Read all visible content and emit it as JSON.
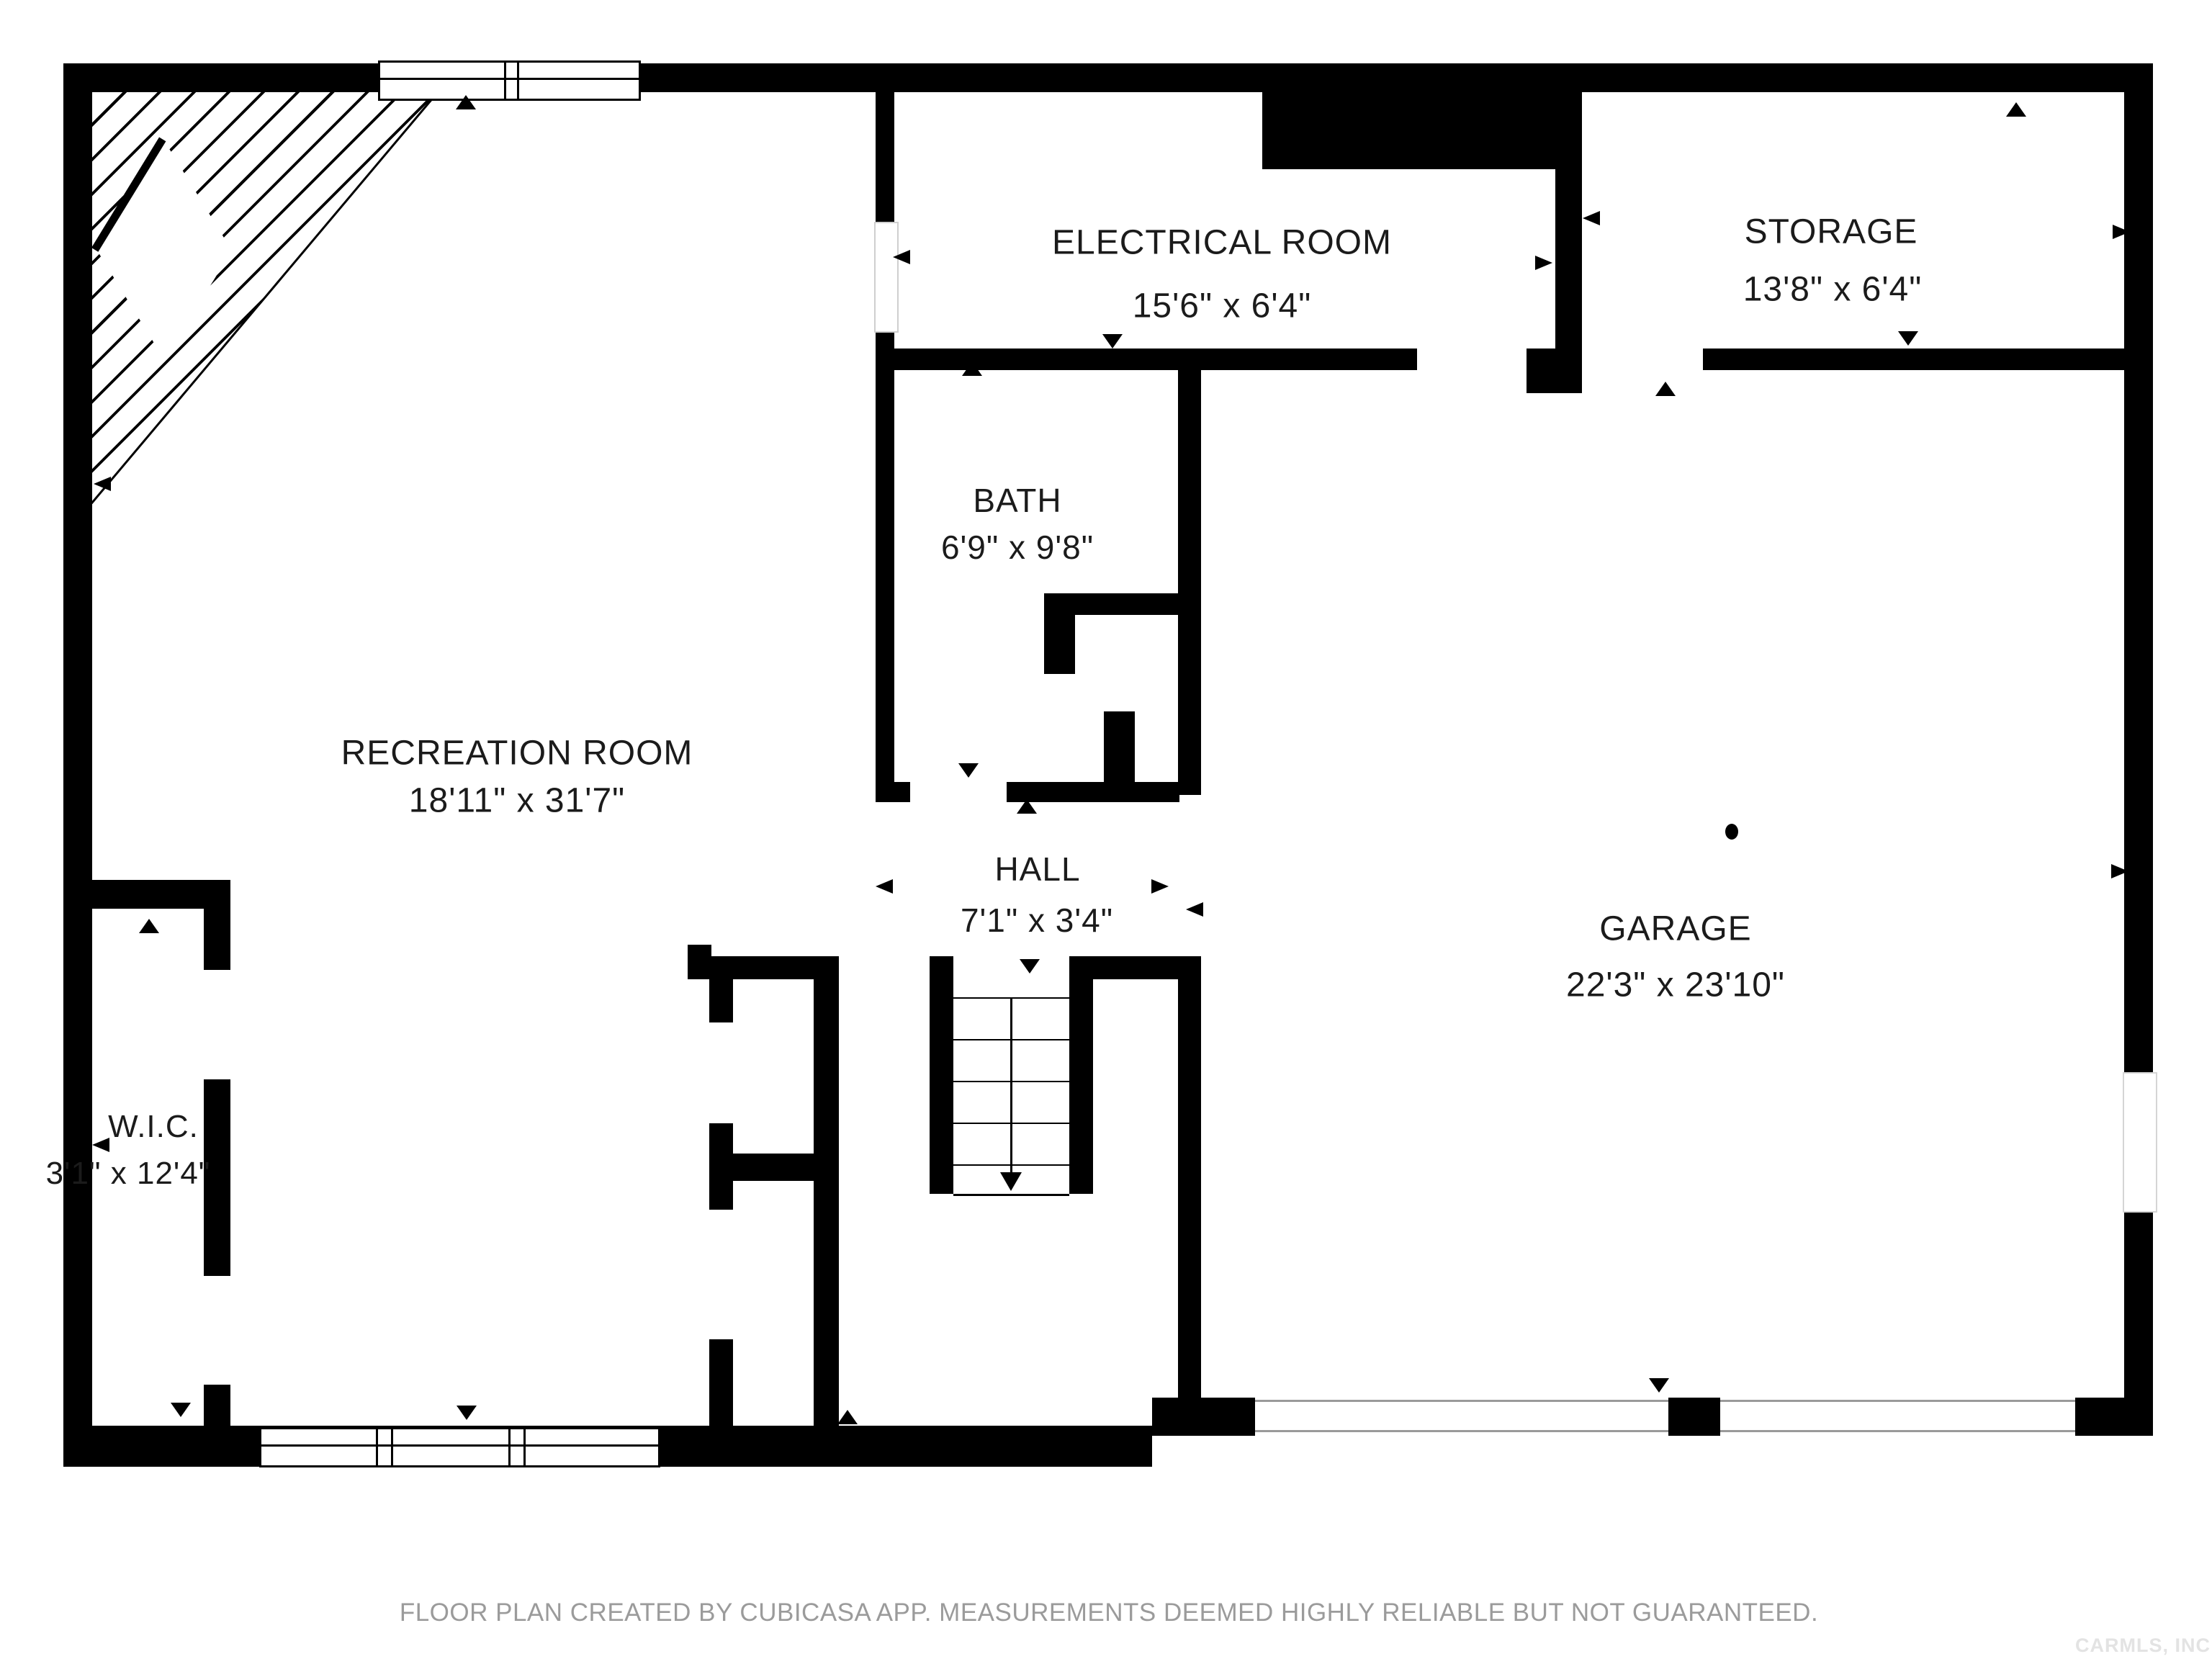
{
  "rooms": {
    "recreation_room": {
      "name": "RECREATION ROOM",
      "dims": "18'11\" x 31'7\""
    },
    "electrical_room": {
      "name": "ELECTRICAL ROOM",
      "dims": "15'6\" x 6'4\""
    },
    "storage": {
      "name": "STORAGE",
      "dims": "13'8\" x 6'4\""
    },
    "bath": {
      "name": "BATH",
      "dims": "6'9\" x 9'8\""
    },
    "hall": {
      "name": "HALL",
      "dims": "7'1\" x 3'4\""
    },
    "garage": {
      "name": "GARAGE",
      "dims": "22'3\" x 23'10\""
    },
    "wic": {
      "name": "W.I.C.",
      "dims": "3'1\" x 12'4\""
    }
  },
  "footer": {
    "disclaimer": "FLOOR PLAN CREATED BY CUBICASA APP. MEASUREMENTS DEEMED HIGHLY RELIABLE BUT NOT GUARANTEED."
  },
  "watermark": {
    "text": "CARMLS, INC"
  },
  "colors": {
    "wall": "#000000",
    "background": "#ffffff",
    "footer_text": "#9b9b9b",
    "watermark_text": "#e3e3e3"
  }
}
